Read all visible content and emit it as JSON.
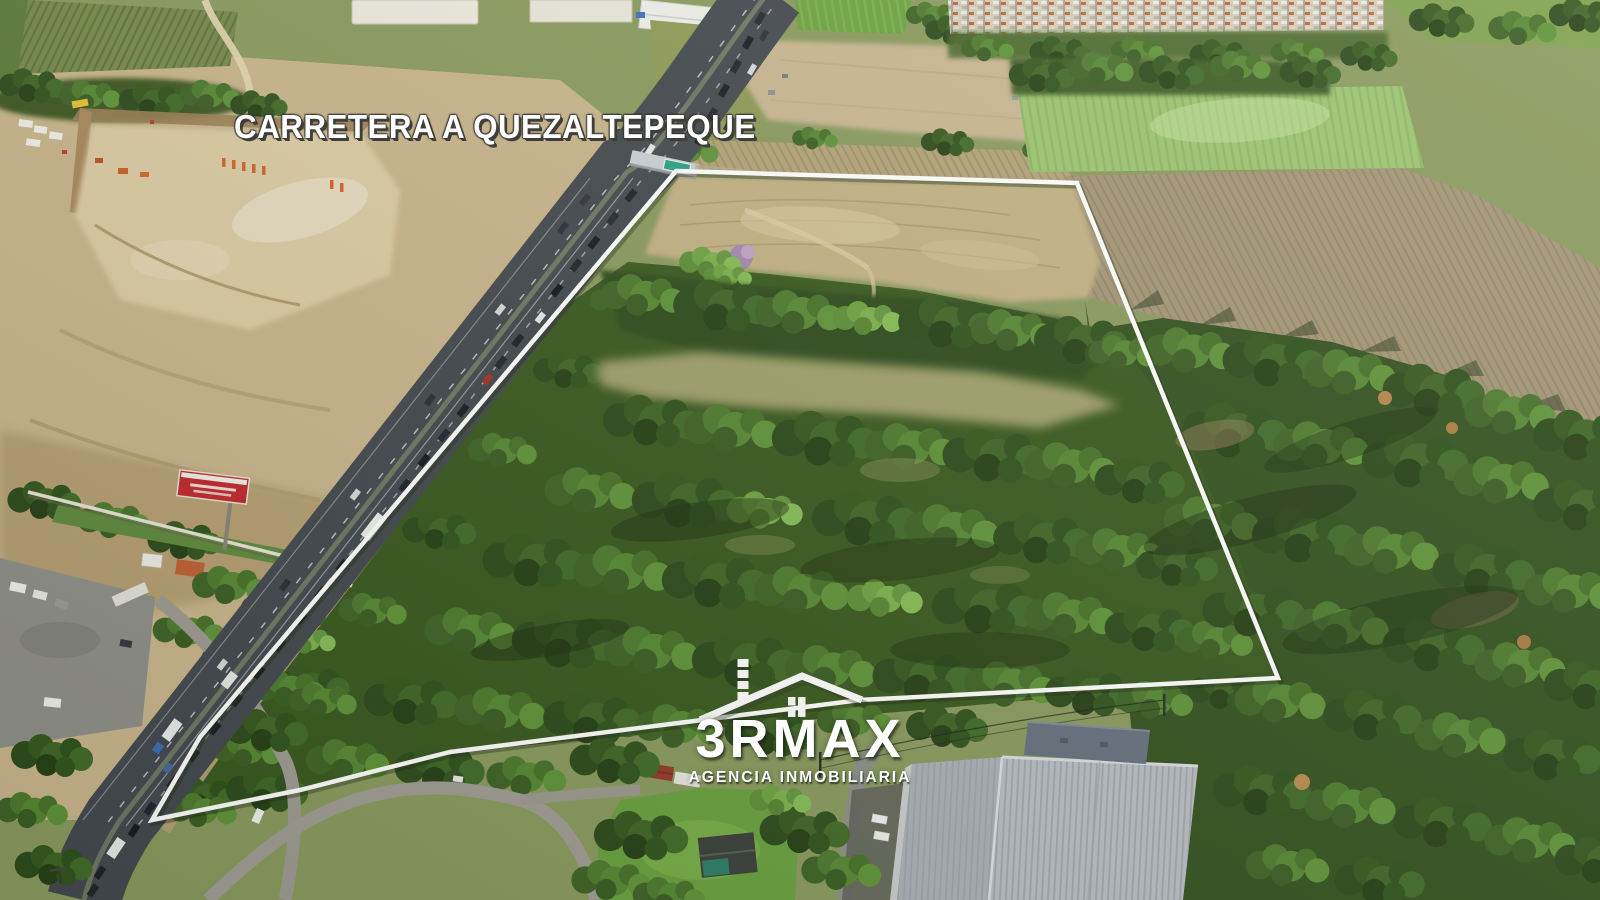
{
  "canvas": {
    "width": 1600,
    "height": 900
  },
  "road_banner": {
    "text": "CARRETERA A QUEZALTEPEQUE"
  },
  "logo": {
    "brand": "3RMAX",
    "tagline": "AGENCIA INMOBILIARIA",
    "icon": "house-outline-icon"
  },
  "boundary": {
    "points": "676,171 1077,183 1278,678 860,700 450,752 300,790 152,820 200,737",
    "color": "#ffffff",
    "stroke_width": 4.5
  },
  "palette": {
    "overlay_white": "#ffffff",
    "overlay_shadow": "#3f3e3a",
    "highway": "#43484e",
    "forest": "#33511f",
    "dirt": "#c9b58c",
    "field_dry": "#c3b184",
    "field_green": "#9cc471",
    "plowed": "#a39577",
    "roof_metal": "#b8bdc2",
    "billboard_red": "#c1272d",
    "sign_green": "#2aa184"
  }
}
